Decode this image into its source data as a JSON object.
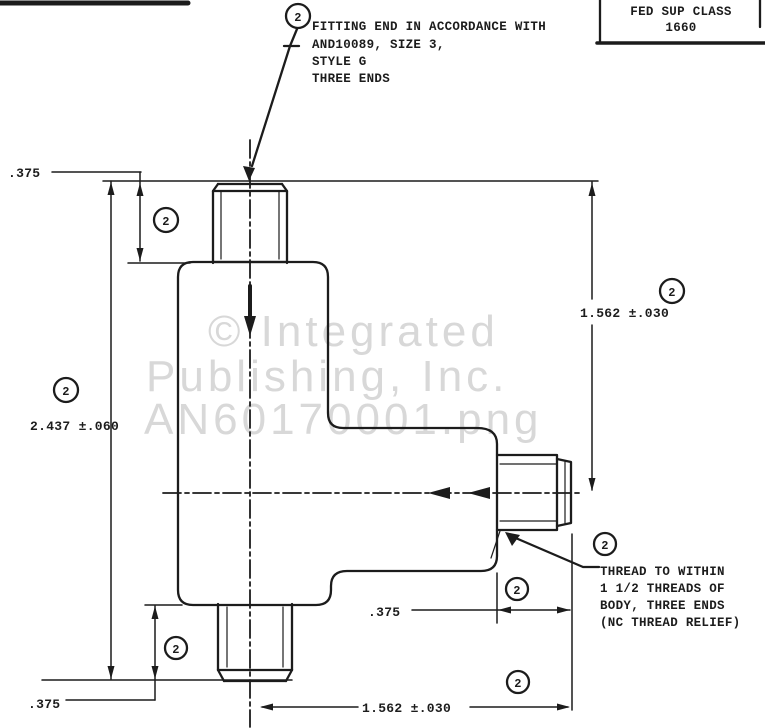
{
  "meta": {
    "ink_color": "#1c1c1c",
    "paper_color": "#ffffff",
    "watermark_color": "#d8d8d8",
    "drawing_subject": "tee fitting with three threaded ends"
  },
  "watermark": {
    "line1": "© Integrated",
    "line2": "Publishing, Inc.",
    "line3": "AN60170001.png"
  },
  "title_block": {
    "line1": "FED SUP CLASS",
    "line2": "1660"
  },
  "notes": {
    "fitting": {
      "l1": "FITTING END IN ACCORDANCE WITH",
      "l2": "AND10089, SIZE 3,",
      "l3": "STYLE G",
      "l4": "THREE ENDS"
    },
    "thread": {
      "l1": "THREAD TO WITHIN",
      "l2": "1 1/2 THREADS OF",
      "l3": "BODY, THREE ENDS",
      "l4": "(NC THREAD RELIEF)"
    }
  },
  "dims": {
    "top_375": ".375",
    "left_2437": "2.437 ±.060",
    "right_1562": "1.562 ±.030",
    "mid_375": ".375",
    "bottom_left_375": ".375",
    "bottom_1562": "1.562 ±.030"
  },
  "flag": {
    "value": "2"
  }
}
